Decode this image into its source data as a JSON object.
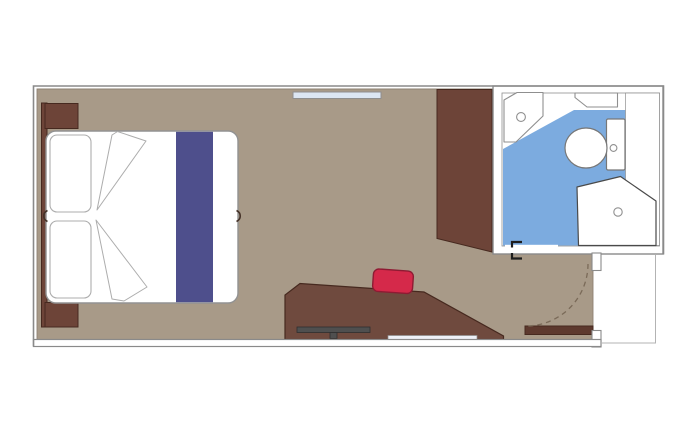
{
  "plan": {
    "kind": "cruise-cabin-floor-plan",
    "rooms": [
      "cabin",
      "bathroom",
      "entry"
    ],
    "furniture": [
      "double-bed",
      "pillows",
      "bed-runner",
      "nightstand-top",
      "nightstand-bottom",
      "headboard-panel",
      "wardrobe",
      "desk",
      "tv",
      "desk-shelf",
      "stool",
      "window",
      "entry-door",
      "door-swing-arc",
      "sink",
      "vanity-shelf",
      "toilet",
      "shower",
      "bathroom-door-hinges"
    ]
  },
  "colors": {
    "floor": "#a89a88",
    "floorEdge": "#8d8173",
    "wood": "#6d4438",
    "woodDesk": "#6f4a3e",
    "woodDark": "#46291f",
    "doorBar": "#5d392e",
    "runner": "#4e4f8c",
    "bathBlue": "#7cabdf",
    "bedWhite": "#ffffff",
    "bedLine": "#929292",
    "softOutline": "#adadad",
    "notch": "#453228",
    "outline": "#8a8a8a",
    "fixture": "#8f8f8f",
    "toiletLine": "#777777",
    "showerLine": "#4a4a4a",
    "red": "#d5294a",
    "redDark": "#8e1b33",
    "window": "#dce6f3",
    "tv": "#4f4f4f",
    "tvDark": "#2f2f2f",
    "shelf": "#eef1f7",
    "arc": "#7a6a58",
    "hinge": "#1d1d1d",
    "alcove": "#b3b3b3"
  }
}
